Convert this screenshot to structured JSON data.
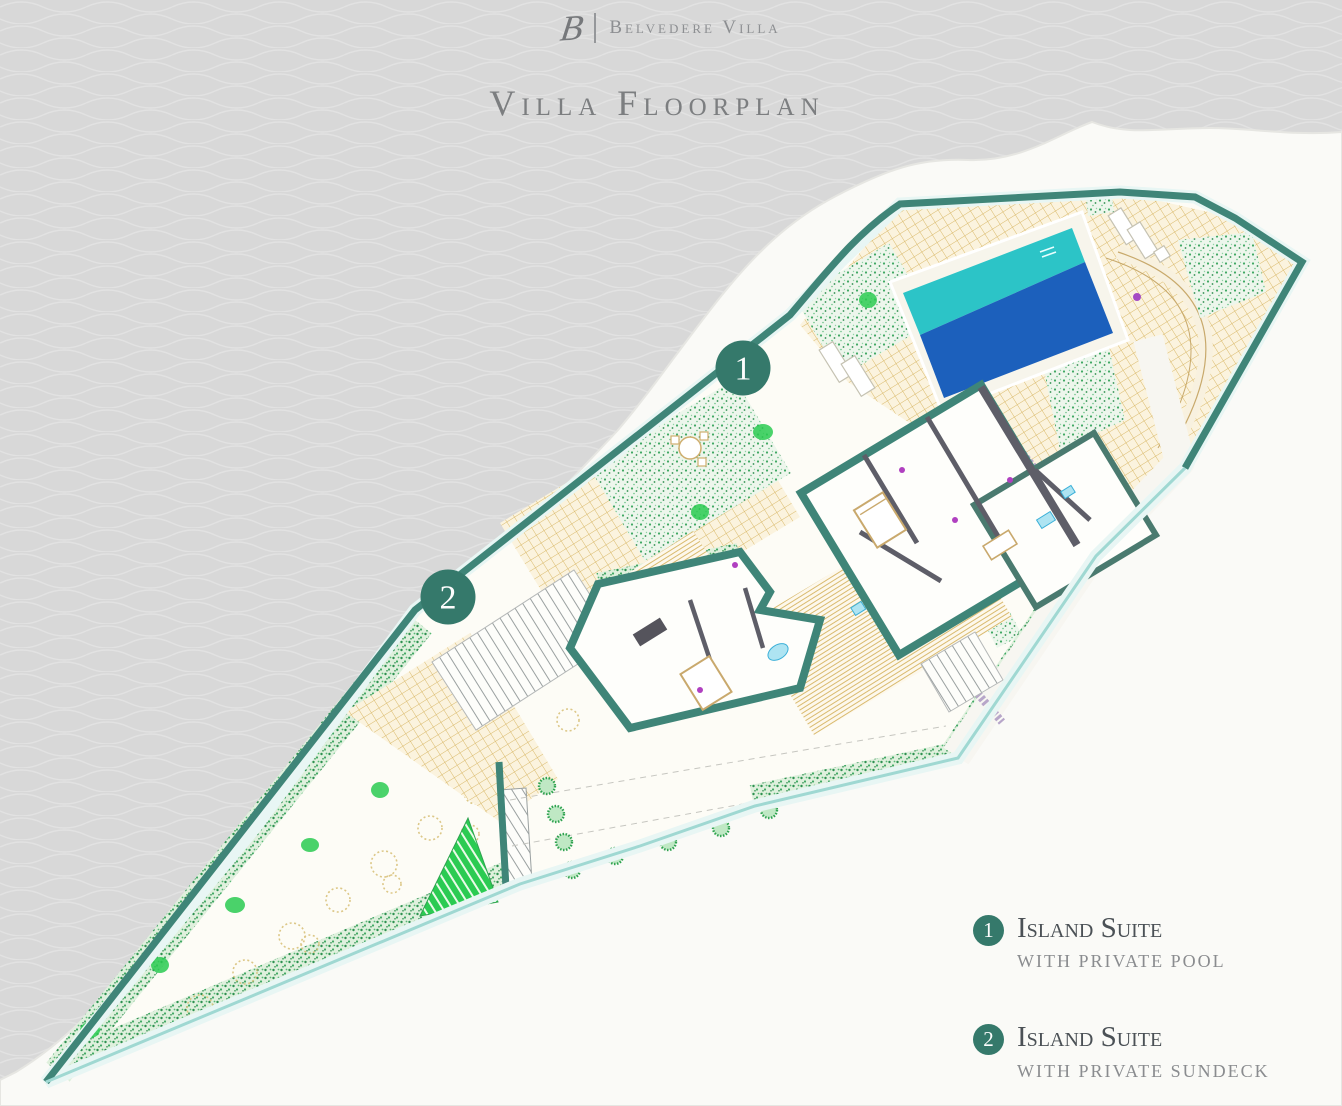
{
  "header": {
    "monogram": "B",
    "brand": "Belvedere Villa"
  },
  "title": "Villa Floorplan",
  "markers": [
    {
      "number": "1"
    },
    {
      "number": "2"
    }
  ],
  "legend": [
    {
      "number": "1",
      "title": "Island Suite",
      "subtitle": "with private pool"
    },
    {
      "number": "2",
      "title": "Island Suite",
      "subtitle": "with private sundeck"
    }
  ],
  "colors": {
    "background_gray": "#D8D8D8",
    "landmass_white": "#FAFAF7",
    "accent_teal": "#35796B",
    "wall_teal": "#3F8578",
    "pool_cyan": "#2CC4C7",
    "pool_blue": "#1C60BC",
    "paving_tan": "#D9B96A",
    "garden_green": "#3FA862",
    "bright_green": "#2BCB52",
    "dark_wall_gray": "#5E5E68"
  }
}
